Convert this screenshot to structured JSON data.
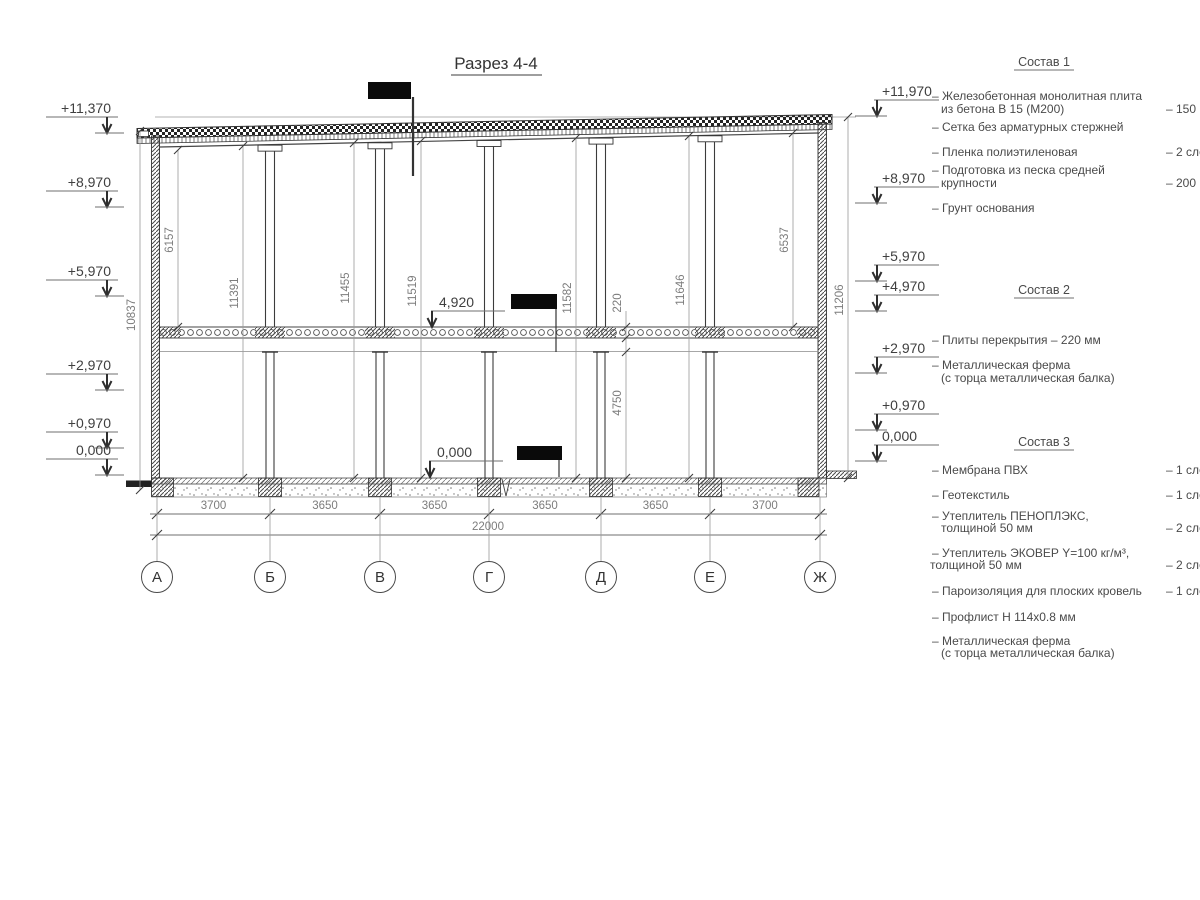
{
  "title": "Разрез 4-4",
  "levels": {
    "left": [
      "+11,370",
      "+8,970",
      "+5,970",
      "+2,970",
      "+0,970",
      "0,000"
    ],
    "right": [
      "+11,970",
      "+8,970",
      "+5,970",
      "+4,970",
      "+2,970",
      "+0,970",
      "0,000"
    ],
    "interior": [
      "4,920",
      "0,000"
    ]
  },
  "dims": {
    "vertical": [
      "10837",
      "6157",
      "11391",
      "11455",
      "11519",
      "11582",
      "220",
      "11646",
      "6537",
      "11206",
      "4750"
    ],
    "bays": [
      "3700",
      "3650",
      "3650",
      "3650",
      "3650",
      "3700"
    ],
    "total": "22000"
  },
  "axes": [
    "А",
    "Б",
    "В",
    "Г",
    "Д",
    "Е",
    "Ж"
  ],
  "notes": [
    {
      "title": "Состав 1",
      "items": [
        {
          "lines": [
            "– Железобетонная  монолитная плита",
            "из бетона В 15 (М200)"
          ],
          "value": "– 150 мм"
        },
        {
          "lines": [
            "– Сетка без арматурных стержней"
          ],
          "value": ""
        },
        {
          "lines": [
            "– Пленка полиэтиленовая"
          ],
          "value": "– 2 слоя"
        },
        {
          "lines": [
            "– Подготовка из песка средней",
            "крупности"
          ],
          "value": "– 200 мм"
        },
        {
          "lines": [
            "– Грунт основания"
          ],
          "value": ""
        }
      ]
    },
    {
      "title": "Состав 2",
      "items": [
        {
          "lines": [
            "– Плиты перекрытия – 220 мм"
          ],
          "value": ""
        },
        {
          "lines": [
            "– Металлическая ферма",
            "(с торца металлическая балка)"
          ],
          "value": ""
        }
      ]
    },
    {
      "title": "Состав 3",
      "items": [
        {
          "lines": [
            "– Мембрана ПВХ"
          ],
          "value": "– 1 слой"
        },
        {
          "lines": [
            "– Геотекстиль"
          ],
          "value": "– 1 слой"
        },
        {
          "lines": [
            "– Утеплитель ПЕНОПЛЭКС,",
            "толщиной 50 мм"
          ],
          "value": "– 2 слоя"
        },
        {
          "lines": [
            "– Утеплитель ЭКОВЕР Y=100 кг/м³,",
            "толщиной 50 мм"
          ],
          "value": "– 2 слоя"
        },
        {
          "lines": [
            "– Пароизоляция для плоских кровель"
          ],
          "value": "– 1 слой"
        },
        {
          "lines": [
            "– Профлист Н 114х0.8 мм"
          ],
          "value": ""
        },
        {
          "lines": [
            "– Металлическая ферма",
            "(с торца металлическая балка)"
          ],
          "value": ""
        }
      ]
    }
  ]
}
